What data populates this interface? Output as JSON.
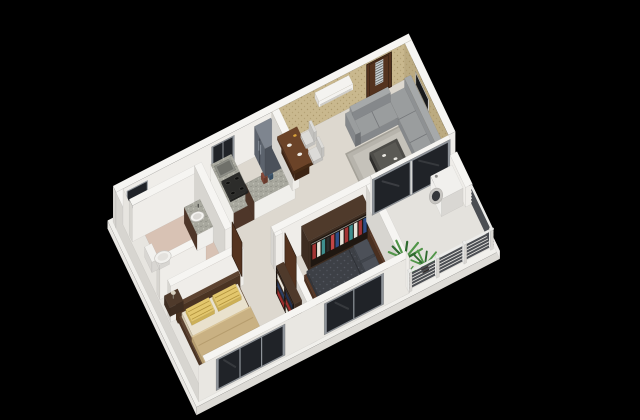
{
  "scene": {
    "type": "3d-isometric-floor-plan-render",
    "background": "#000000",
    "rooms": [
      "living-room",
      "kitchen",
      "hallway",
      "bathroom",
      "master-bedroom",
      "bedroom-2",
      "balcony"
    ],
    "furniture": [
      "entrance-door",
      "air-conditioner",
      "wall-tv",
      "sofa",
      "coffee-table",
      "area-rug",
      "dining-table",
      "dining-chairs",
      "refrigerator",
      "kitchen-counter",
      "gas-stove",
      "kitchen-sink",
      "kitchen-window",
      "bathroom-window",
      "toilet",
      "washbasin",
      "wardrobe",
      "bookshelf",
      "master-bed",
      "nightstand",
      "bed-2",
      "sliding-glass-door",
      "washing-machine",
      "balcony-railing",
      "potted-plants",
      "front-windows"
    ]
  },
  "palette": {
    "background": "#000000",
    "wallTop": "#f6f5f2",
    "wallLit": "#efede9",
    "wallInner": "#e7e5e0",
    "wallShade": "#d7d5d0",
    "wallOuter": "#e9e7e2",
    "wallpaper1": "#c9b88e",
    "wallpaper2": "#bcab81",
    "wallpaperDot": "#a28d60",
    "floorMain": "#ddd8cf",
    "floorBath": "#d8c2b4",
    "floorBalcony": "#e4e2dd",
    "plinthTop": "#f1f0ec",
    "plinthSide": "#e8e6e2",
    "plinthFace": "#dddbd6",
    "plinthSide2": "#efedea",
    "rug": "#b7b4ac",
    "rugInner": "#c5c2ba",
    "rugBorder": "#a5a299",
    "graniteBase": "#a8a89e",
    "graniteDark": "#84847b",
    "graniteLight": "#cfcfc5",
    "counterFace": "#f0efeb",
    "counterSide": "#4e3629",
    "fridgeTop": "#7e858f",
    "fridgeFront": "#5c636d",
    "fridgeSide": "#4b515a",
    "fridgeLine": "#3d434b",
    "fridgeHandle": "#8b929c",
    "stove": "#2c2c2a",
    "burner": "#0f0f0e",
    "sinkOuter": "#8f9089",
    "sinkInner": "#6f706a",
    "woodTop": "#6b4328",
    "woodSide": "#533320",
    "woodSide2": "#452a15",
    "doorWood": "#54331f",
    "doorGlass": "#c9d0d4",
    "doorGrid": "#5f5f5b",
    "acBody": "#f4f3f0",
    "acShade": "#dcdad6",
    "acVent": "#c5c3be",
    "tvFrame": "#e9e8e5",
    "tvScreen": "#17181a",
    "sofaTop": "#9a9d9e",
    "sofaFront": "#85888b",
    "sofaSide": "#6e7174",
    "sofaBack": "#8e9193",
    "sofaBackTop": "#a6a9aa",
    "sofaLine": "#75777a",
    "tableDark": "#2f2e2c",
    "tableTop": "#4c4b47",
    "tableGlass": "#5a5954",
    "chairSeat": "#dcdbd8",
    "chairShade": "#c2c1be",
    "bedFrame": "#5d4330",
    "bedFrameDark": "#4a3322",
    "mattress": "#e9e1cd",
    "mattressShade": "#d3c8ae",
    "pillowY": "#e3c76d",
    "pillowYShade": "#cdb056",
    "pillowStripe": "#b2933c",
    "blanket": "#c9b183",
    "blanketShade": "#b69d6e",
    "blanketLight": "#dcc79a",
    "bed2Frame": "#5a3a28",
    "bed2FrameDark": "#45291a",
    "bed2Bedding": "#3d4046",
    "bed2Shade": "#33363c",
    "bed2Pattern": "#565a63",
    "bed2Pillow": "#4c5058",
    "bed2PillowShade": "#41454c",
    "wrTop": "#4f3a2b",
    "wrFrame": "#3e2d21",
    "wrInterior": "#1f1711",
    "wrRail": "#9b9b95",
    "shelfBack": "#1d1510",
    "glassDark": "#202328",
    "glassFrame": "#8f949a",
    "railSlat": "#4b4e53",
    "railPost": "#ececea",
    "railPostShade": "#d8d6d2",
    "plantG1": "#2f6b2f",
    "plantG2": "#519649",
    "potDark": "#3a2f28",
    "potSide": "#2e2520",
    "wmBody": "#f1f0ed",
    "wmShade": "#d9d7d3",
    "wmRing": "#c7c5c1",
    "wmGlass": "#34363a",
    "toiletWhite": "#f2f1ee",
    "toiletShade": "#d8d6d2",
    "basinFront": "#f0efec",
    "itemWhite": "#eceae4",
    "itemYellow": "#d9a33a"
  },
  "wardrobe_clothes": [
    "#a33434",
    "#e7e3d9",
    "#3f8f8f",
    "#2b2b2b",
    "#c24646",
    "#2e4d86",
    "#e7e3d9",
    "#a33434",
    "#3f8f8f",
    "#e7e3d9",
    "#a33434",
    "#2e4d86"
  ],
  "shelf_items": [
    [
      "#9c2f2f",
      "#e8e4da"
    ],
    [
      "#2e3f63",
      "#9c2f2f"
    ],
    [
      "#e8e4da",
      "#23314f"
    ]
  ]
}
